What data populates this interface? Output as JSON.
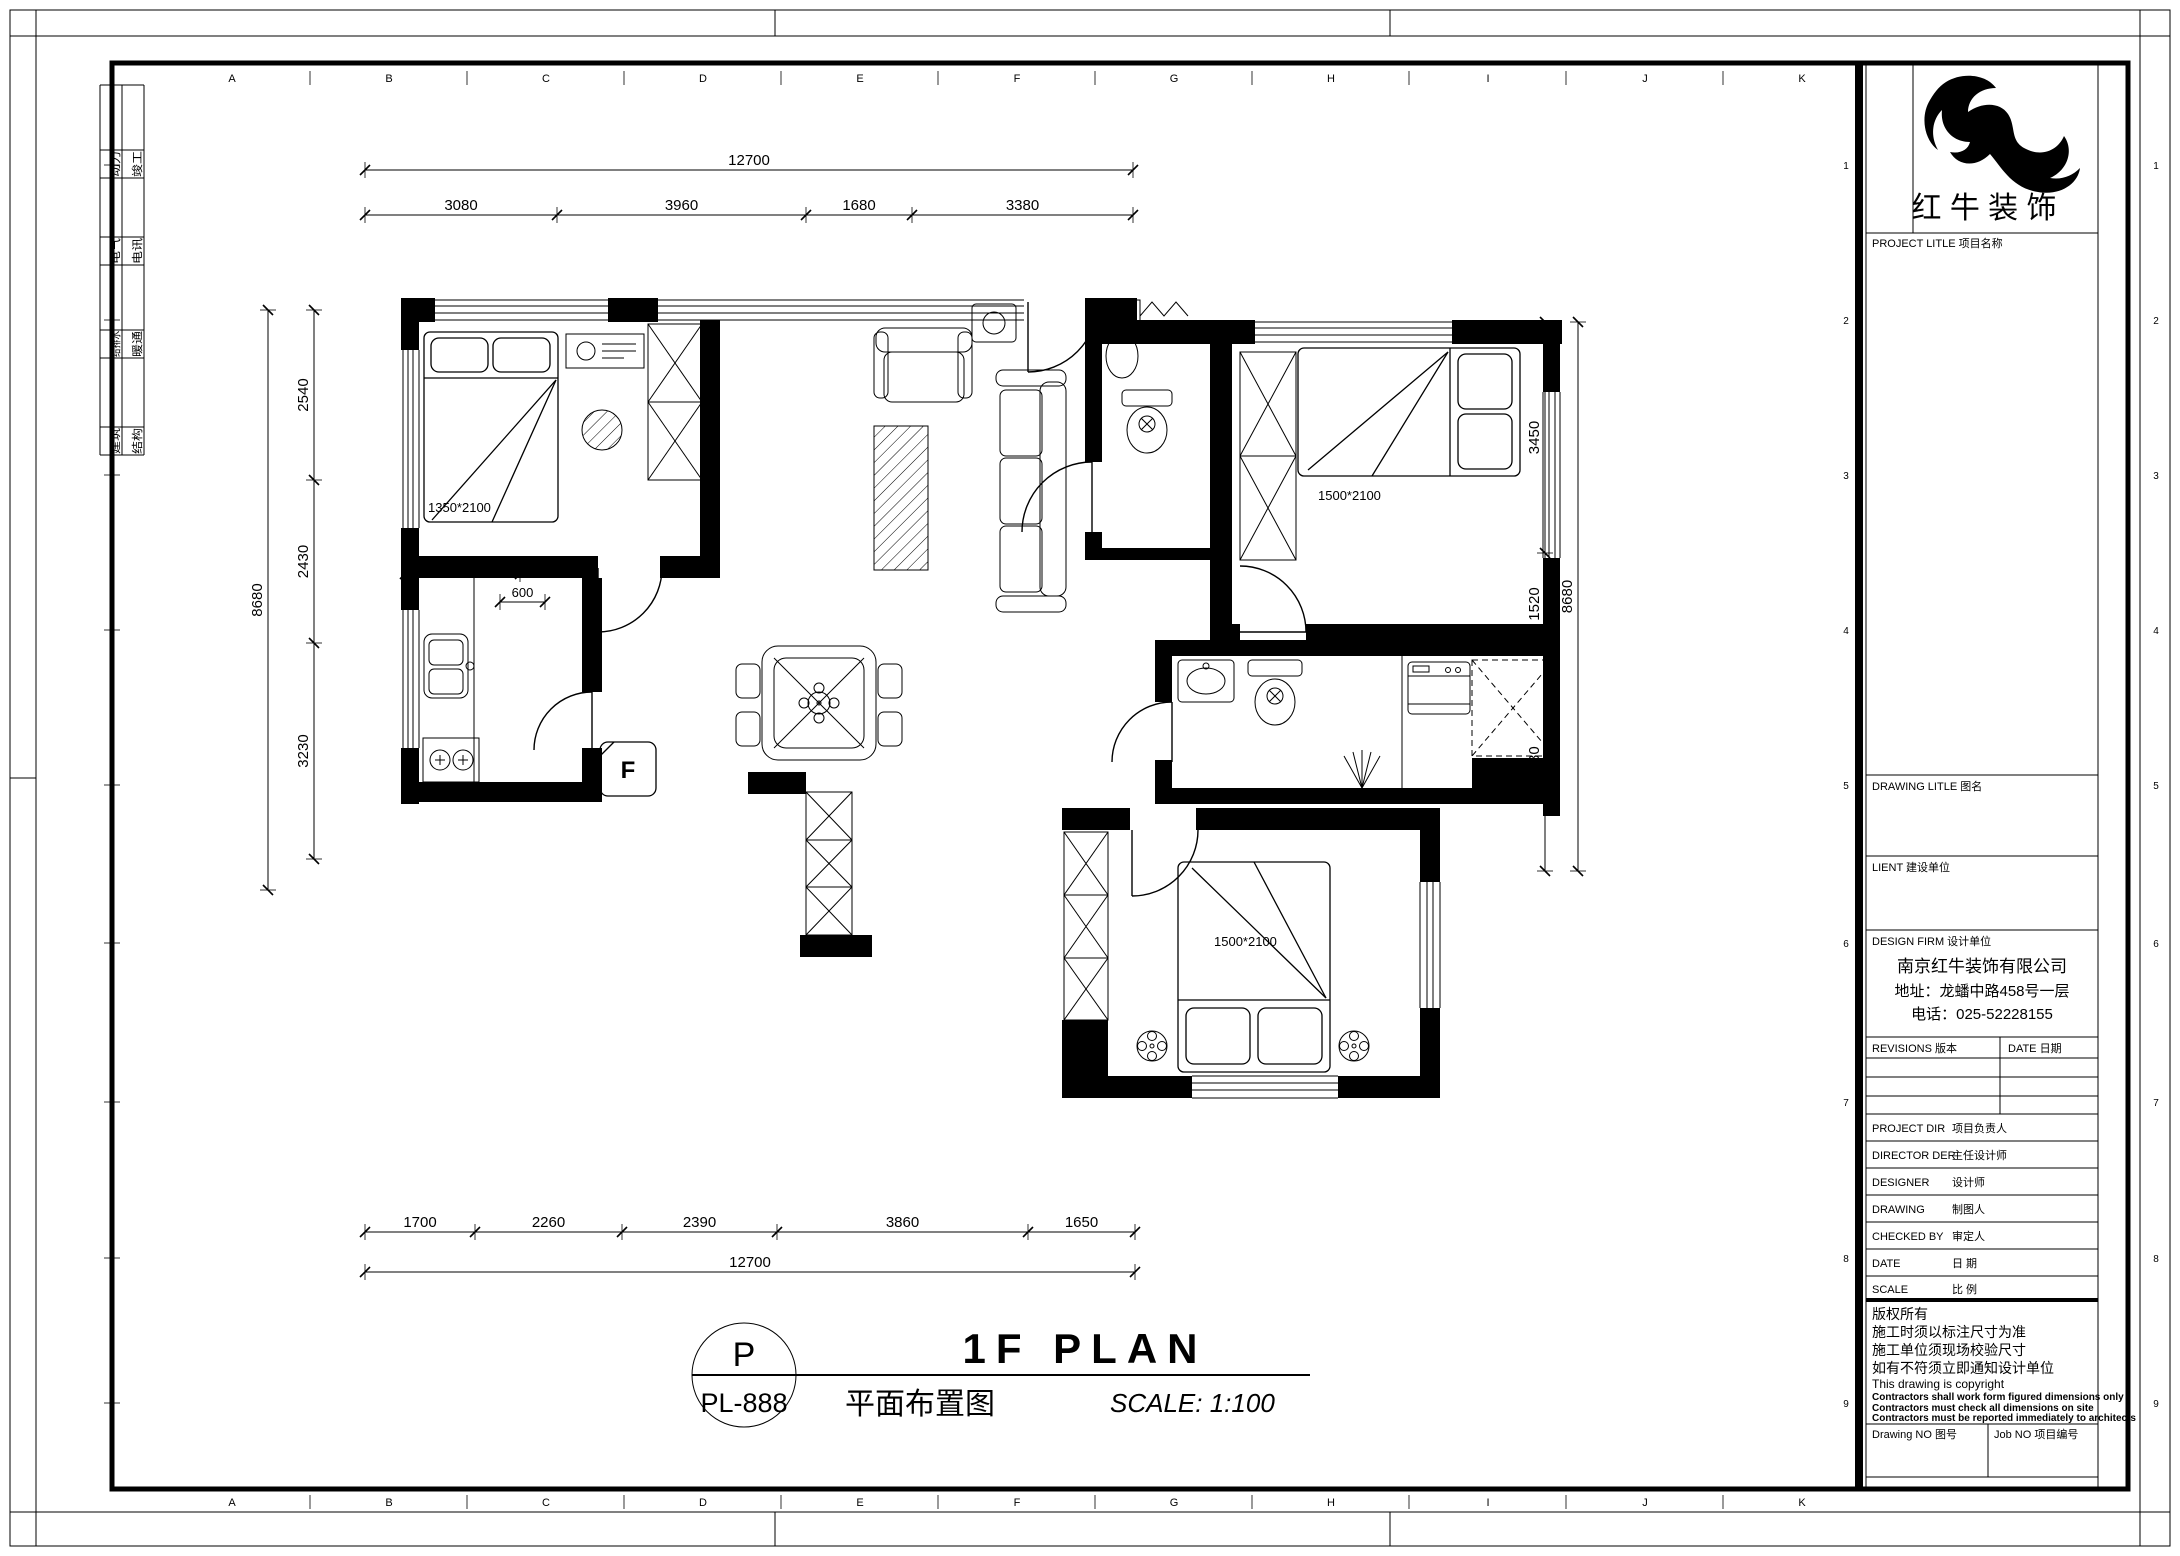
{
  "grid": {
    "columns": [
      "A",
      "B",
      "C",
      "D",
      "E",
      "F",
      "G",
      "H",
      "I",
      "J",
      "K"
    ],
    "rows": [
      "1",
      "2",
      "3",
      "4",
      "5",
      "6",
      "7",
      "8",
      "9"
    ]
  },
  "side_strip": {
    "rows": [
      [
        "动力",
        "竣工"
      ],
      [
        "电气",
        "电讯"
      ],
      [
        "给排水",
        "暖通"
      ],
      [
        "建筑",
        "结构"
      ]
    ]
  },
  "title_block": {
    "logo_text": "红 牛 装 饰",
    "project_title": "PROJECT LITLE  项目名称",
    "drawing_title": "DRAWING LITLE  图名",
    "client": "LIENT  建设单位",
    "design_firm": "DESIGN FIRM  设计单位",
    "company_name": "南京红牛装饰有限公司",
    "company_address": "地址：龙蟠中路458号一层",
    "company_phone": "电话：025-52228155",
    "revisions": "REVISIONS  版本",
    "date_header": "DATE  日期",
    "rows": [
      {
        "en": "PROJECT DIR",
        "cn": "项目负责人"
      },
      {
        "en": "DIRECTOR DER",
        "cn": "主任设计师"
      },
      {
        "en": "DESIGNER",
        "cn": "设计师"
      },
      {
        "en": "DRAWING",
        "cn": "制图人"
      },
      {
        "en": "CHECKED BY",
        "cn": "审定人"
      },
      {
        "en": "DATE",
        "cn": "日  期"
      },
      {
        "en": "SCALE",
        "cn": "比  例"
      }
    ],
    "copyright_lines": [
      "版权所有",
      "施工时须以标注尺寸为准",
      "施工单位须现场校验尺寸",
      "如有不符须立即通知设计单位",
      "This drawing is copyright",
      "Contractors shall work form figured dimensions only",
      "Contractors must check all dimensions on site",
      "Contractors must be reported immediately to architects"
    ],
    "drawing_no": "Drawing NO  图号",
    "job_no": "Job NO  项目编号"
  },
  "title_bar": {
    "bubble_top": "P",
    "bubble_bottom": "PL-888",
    "title": "1F PLAN",
    "subtitle": "平面布置图",
    "scale": "SCALE: 1:100"
  },
  "dims": {
    "top_total": "12700",
    "top_chain": [
      "3080",
      "3960",
      "1680",
      "3380"
    ],
    "bottom_chain": [
      "1700",
      "2260",
      "2390",
      "3860",
      "1650"
    ],
    "bottom_total": "12700",
    "left_outer": "8680",
    "left_chain": [
      "2540",
      "2430",
      "3230"
    ],
    "right_chain": [
      "3450",
      "1520",
      "3230"
    ],
    "right_outer": "8680",
    "interior": [
      "1130",
      "600"
    ]
  },
  "plan_labels": {
    "bed_master": "1350*2100",
    "bed_right": "1500*2100",
    "bed_bottom": "1500*2100",
    "fridge": "F"
  }
}
